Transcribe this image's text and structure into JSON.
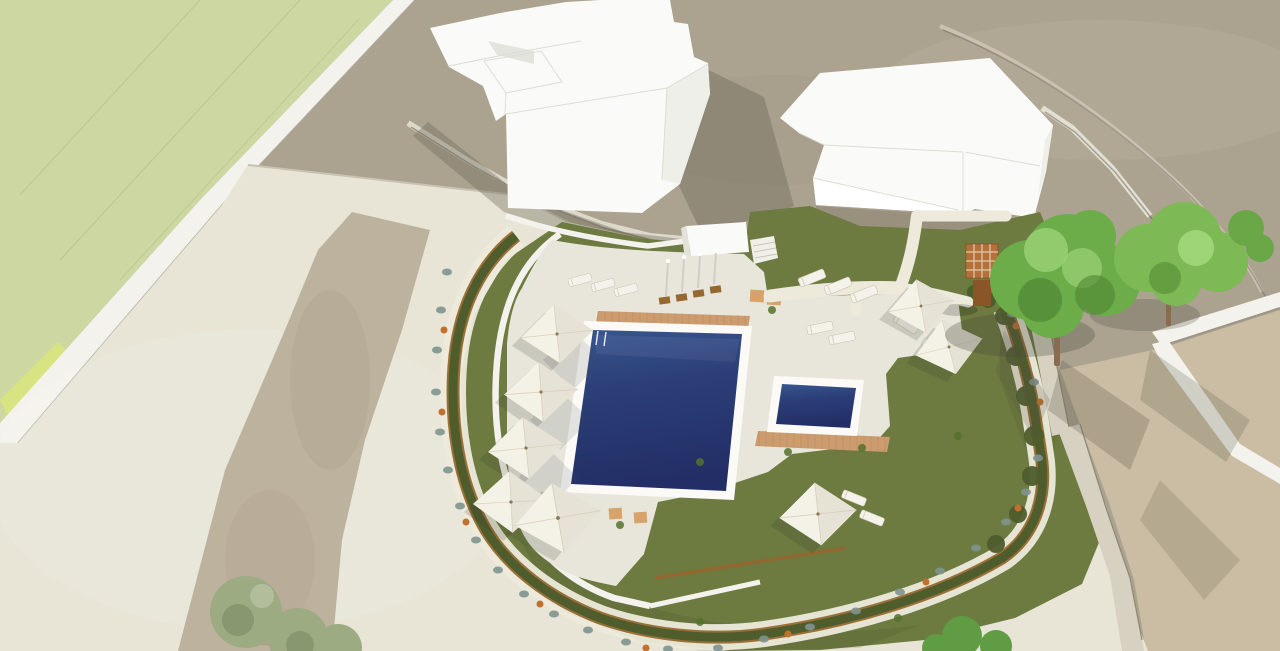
{
  "meta": {
    "type": "3d-architectural-rendering",
    "view": "aerial-perspective",
    "subject": "Communal swimming pool and landscaped garden between white apartment blocks"
  },
  "site": {
    "building_count": 2,
    "pool_count": 2,
    "umbrella_count": 8,
    "sun_lounger_count": 12,
    "outdoor_shower_count": 4,
    "large_tree_count": 2,
    "street_tree_count": 1,
    "pergola_count": 1,
    "features": [
      "rectangular main pool with deep blue water and white coping",
      "small square children's pool",
      "timber deck strips beside both pools",
      "row of white square parasols with loungers along curved west wall",
      "timber perimeter fence with clipped hedge ring",
      "flower border with terracotta pots along outer sidewalk",
      "outdoor shower wall with four showers on timber mats",
      "timber pergola and two mature trees on east lawn",
      "paved paths crossing the lawn toward the buildings",
      "gravel strip in the west forecourt",
      "pale green hillside field to the north-west",
      "open dirt ground and access road to the north-east",
      "neighbouring white boundary walls and sandy plot to the south-east"
    ]
  },
  "colors": {
    "ground": "#aba28f",
    "ground_light": "#bcb3a0",
    "sand": "#cbbda3",
    "field": "#ccd7a1",
    "field_bright": "#d9e47e",
    "wall_white": "#f3f2ec",
    "pavement": "#e8e5d6",
    "path": "#edeadb",
    "gravel": "#b9ae99",
    "lawn": "#6d7a40",
    "hedge": "#4f5d2d",
    "fence": "#96682f",
    "deck": "#e8e6db",
    "pool_coping": "#fbfaf6",
    "pool_light": "#38568f",
    "pool_mid": "#2c3f78",
    "pool_deep": "#232e66",
    "wood": "#cc9c6f",
    "umbrella": "#f4f1e7",
    "furniture": "#f4f2ea",
    "building": "#fafaf8",
    "building_face": "#efefe9",
    "shadow": "#6f6a5a",
    "stone": "#d7d1c1",
    "tree": "#6cad4a",
    "tree2": "#7db954",
    "olive": "#9dab83",
    "shrub": "#7f948f",
    "pot": "#c2702e",
    "pergola": "#b5713c",
    "trunk": "#8a6b4e"
  }
}
